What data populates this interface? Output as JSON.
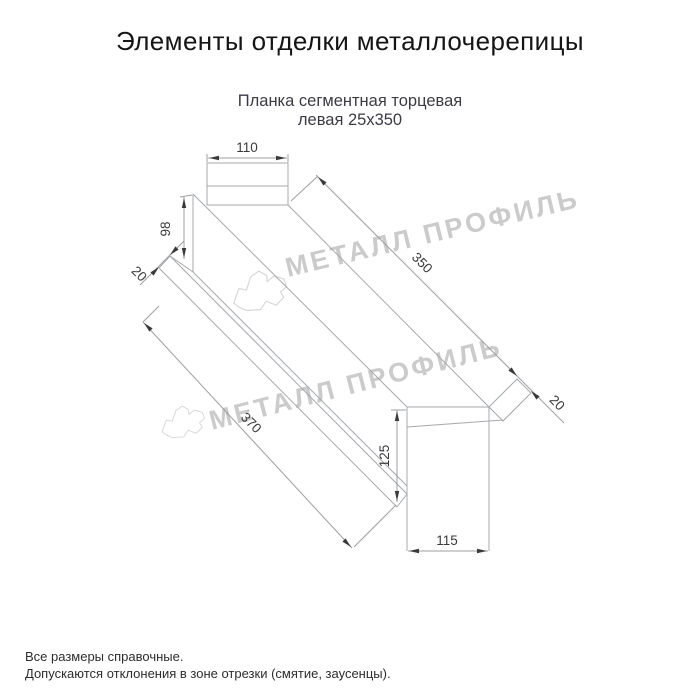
{
  "title": "Элементы отделки металлочерепицы",
  "subtitle": {
    "line1": "Планка сегментная торцевая",
    "line2": "левая 25х350"
  },
  "watermark": {
    "text": "МЕТАЛЛ ПРОФИЛЬ"
  },
  "drawing": {
    "part_name": "Планка сегментная торцевая левая 25х350",
    "dims": {
      "top_flange_width": "110",
      "left_end_height": "98",
      "left_fold": "20",
      "length": "350",
      "overall_length": "370",
      "right_fold": "20",
      "right_end_height": "125",
      "right_end_width": "115"
    }
  },
  "footer": {
    "note1": "Все размеры справочные.",
    "note2": "Допускаются отклонения в зоне отрезки (смятие, заусенцы)."
  }
}
